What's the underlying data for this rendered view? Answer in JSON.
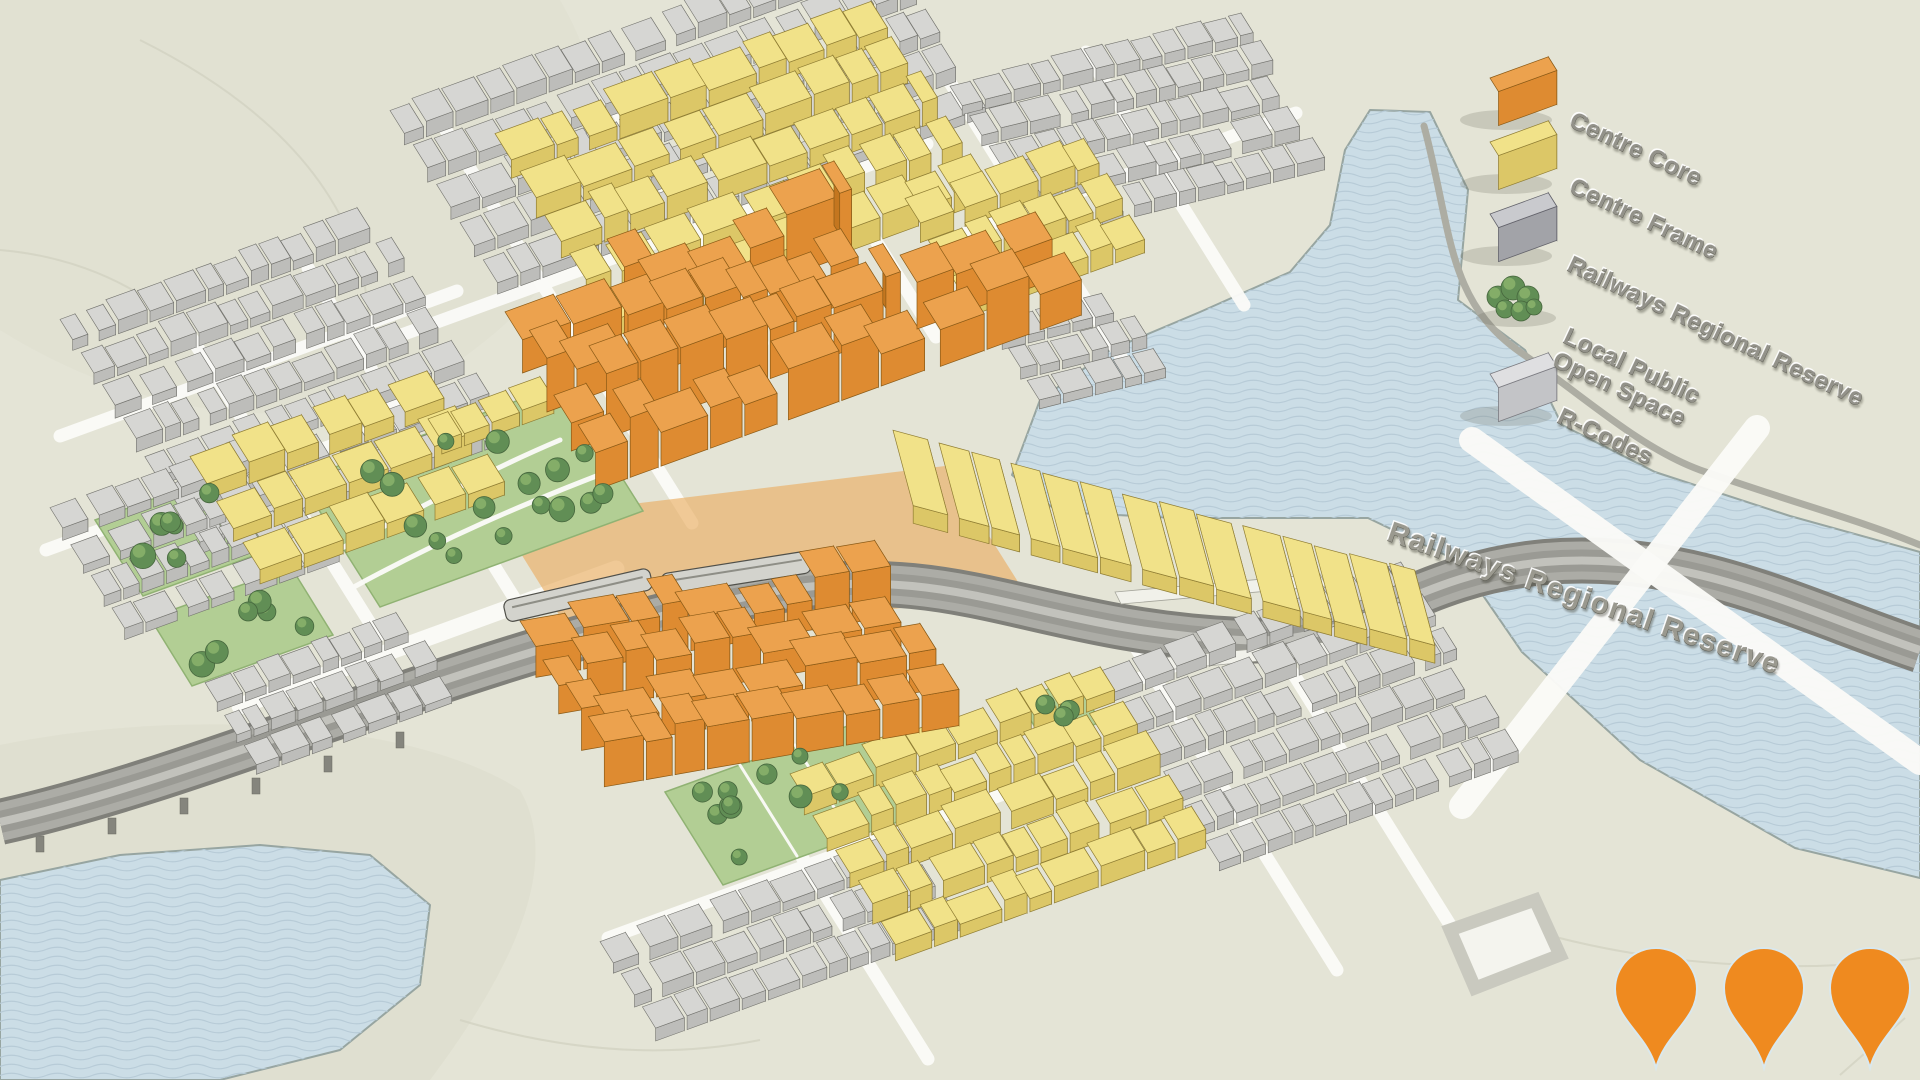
{
  "legend": {
    "items": [
      {
        "id": "centre-core",
        "label": "Centre Core",
        "swatch": "orange-3d-block",
        "color": "#DE8B31"
      },
      {
        "id": "centre-frame",
        "label": "Centre Frame",
        "swatch": "yellow-3d-block",
        "color": "#E8D36E"
      },
      {
        "id": "railways-regional-reserve",
        "label": "Railways Regional Reserve",
        "swatch": "dark-grey-3d-block",
        "color": "#A2A3A8"
      },
      {
        "id": "local-public-open-space",
        "label": "Local Public Open Space",
        "lines": [
          "Local Public",
          "Open Space"
        ],
        "swatch": "trees",
        "color": "#618E55"
      },
      {
        "id": "r-codes",
        "label": "R-Codes",
        "swatch": "light-grey-3d-block",
        "color": "#C3C4C7"
      }
    ]
  },
  "map": {
    "railways_label": "Railways Regional Reserve",
    "markers": {
      "count": 3,
      "color": "#EF8A1F"
    }
  },
  "colors": {
    "background": "#E4E4D6",
    "water": "#CBDDE6",
    "water_wave": "#B7CBD7",
    "road": "#FAFAF7",
    "rail": "#ACACA6",
    "park": "#B2CE94",
    "core_top": "#ECA24E",
    "core_front": "#DE8B31",
    "frame_top": "#F1E289",
    "frame_front": "#DCC767",
    "rcodes_top": "#D6D6D3",
    "rcodes_front": "#BDBDBA",
    "tree": "#618E55",
    "legend_text": "#93928A",
    "pin": "#EF8A1F"
  }
}
